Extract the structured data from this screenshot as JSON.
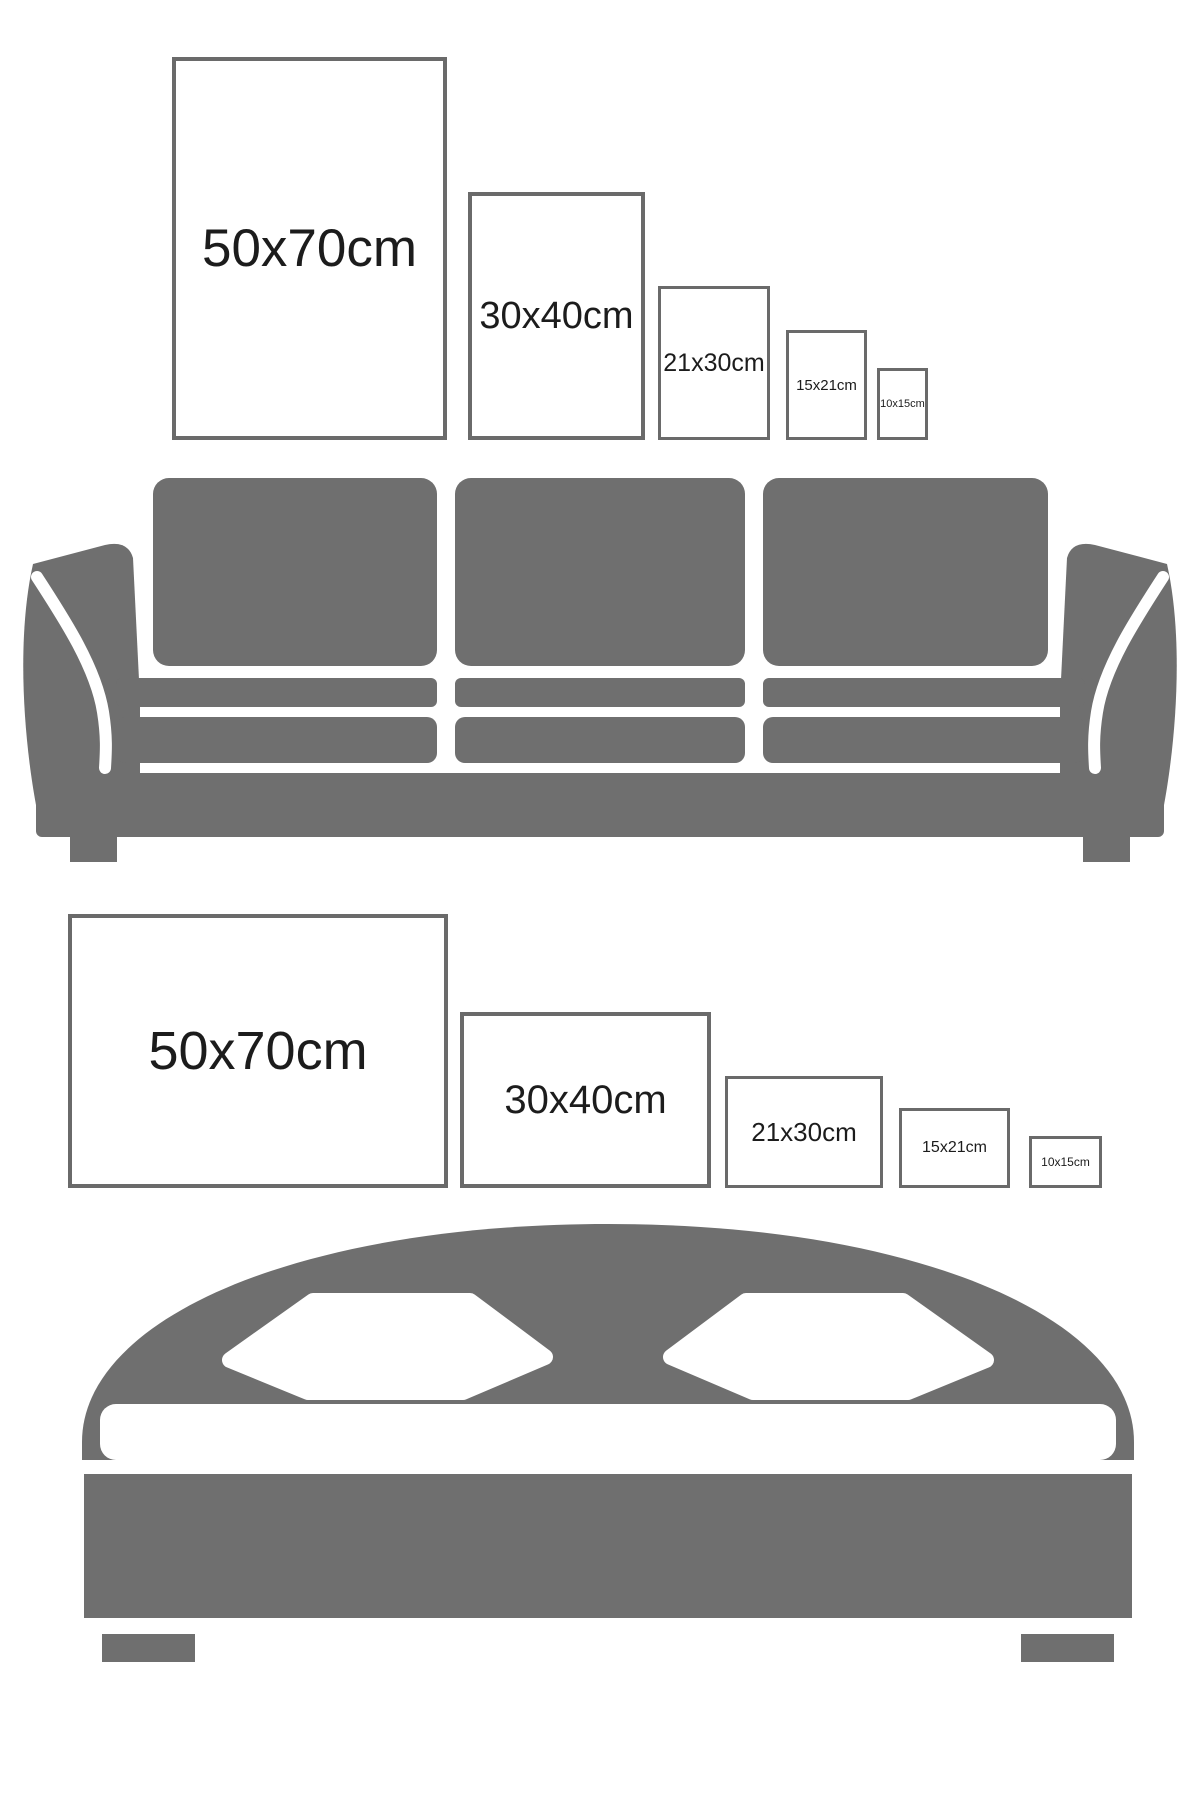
{
  "colors": {
    "furniture": "#6f6f6f",
    "frame_border": "#6a6a6a",
    "label_text": "#1c1c1c",
    "cutout": "#ffffff"
  },
  "illustrations": {
    "sofa": "three-seat-sofa-silhouette",
    "bed": "double-bed-silhouette"
  },
  "wall_art_over_sofa": {
    "orientation": "portrait",
    "frames": [
      {
        "label": "50x70cm",
        "left": 172,
        "top": 57,
        "width": 275,
        "height": 383,
        "border": 4,
        "font": 53
      },
      {
        "label": "30x40cm",
        "left": 468,
        "top": 192,
        "width": 177,
        "height": 248,
        "border": 4,
        "font": 38
      },
      {
        "label": "21x30cm",
        "left": 658,
        "top": 286,
        "width": 112,
        "height": 154,
        "border": 3,
        "font": 25
      },
      {
        "label": "15x21cm",
        "left": 786,
        "top": 330,
        "width": 81,
        "height": 110,
        "border": 3,
        "font": 15
      },
      {
        "label": "10x15cm",
        "left": 877,
        "top": 368,
        "width": 51,
        "height": 72,
        "border": 3,
        "font": 11
      }
    ]
  },
  "wall_art_over_bed": {
    "orientation": "landscape",
    "frames": [
      {
        "label": "50x70cm",
        "left": 68,
        "top": 914,
        "width": 380,
        "height": 274,
        "border": 4,
        "font": 54
      },
      {
        "label": "30x40cm",
        "left": 460,
        "top": 1012,
        "width": 251,
        "height": 176,
        "border": 4,
        "font": 40
      },
      {
        "label": "21x30cm",
        "left": 725,
        "top": 1076,
        "width": 158,
        "height": 112,
        "border": 3,
        "font": 26
      },
      {
        "label": "15x21cm",
        "left": 899,
        "top": 1108,
        "width": 111,
        "height": 80,
        "border": 3,
        "font": 16
      },
      {
        "label": "10x15cm",
        "left": 1029,
        "top": 1136,
        "width": 73,
        "height": 52,
        "border": 3,
        "font": 12
      }
    ]
  }
}
